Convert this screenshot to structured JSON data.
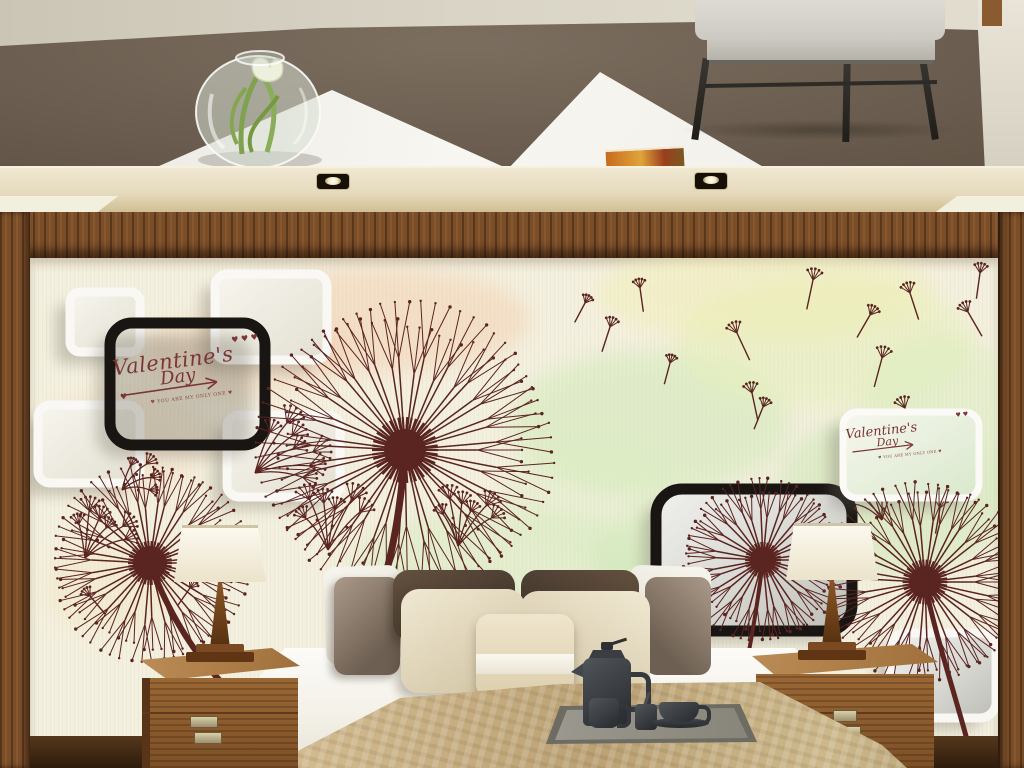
{
  "meta": {
    "title": "Bedroom 3D dandelion wallpaper mural mockup"
  },
  "palette": {
    "dandelion": "#5a2421",
    "black_frame": "#181512",
    "white_box_stroke": "#f9f8f4",
    "cream_wall": "#f4f0df",
    "runner_gold": "#c2ab7e",
    "wood": "#7a4e29"
  },
  "valentine_main": {
    "line1": "Valentine's",
    "line2": "Day",
    "hearts": "♥ ♥ ♥",
    "subtitle": "♥ YOU ARE MY ONLY ONE ♥"
  },
  "valentine_card": {
    "line1": "Valentine's",
    "line2": "Day",
    "hearts": "♥ ♥",
    "subtitle": "♥ YOU ARE MY ONLY ONE ♥"
  },
  "mural": {
    "layers": [
      {
        "type": "watercolors",
        "items": [
          [
            350,
            62,
            150,
            52,
            "#f3cfae",
            0.5
          ],
          [
            215,
            95,
            105,
            42,
            "#f0c9a8",
            0.35
          ],
          [
            80,
            330,
            70,
            45,
            "#f0e3b8",
            0.3
          ],
          [
            90,
            185,
            90,
            52,
            "#f2d4b6",
            0.3
          ],
          [
            620,
            165,
            140,
            72,
            "#cde9b4",
            0.5
          ],
          [
            795,
            85,
            150,
            65,
            "#e4efb6",
            0.5
          ],
          [
            865,
            235,
            120,
            82,
            "#c6e6ae",
            0.45
          ],
          [
            470,
            305,
            150,
            55,
            "#cfe9b8",
            0.4
          ],
          [
            680,
            305,
            120,
            60,
            "#c9e7b2",
            0.45
          ],
          [
            735,
            35,
            170,
            48,
            "#f0eeb4",
            0.5
          ],
          [
            915,
            140,
            80,
            58,
            "#d4ecb8",
            0.4
          ],
          [
            560,
            240,
            90,
            60,
            "#d8edc0",
            0.35
          ]
        ]
      },
      {
        "type": "boxes",
        "items": [
          {
            "x": 40,
            "y": 34,
            "w": 70,
            "h": 60,
            "rx": 10,
            "style": "whiteBox"
          },
          {
            "x": 185,
            "y": 16,
            "w": 112,
            "h": 86,
            "rx": 12,
            "style": "whiteBox"
          },
          {
            "x": 8,
            "y": 147,
            "w": 102,
            "h": 78,
            "rx": 12,
            "style": "whiteBox"
          },
          {
            "x": 197,
            "y": 157,
            "w": 113,
            "h": 82,
            "rx": 12,
            "style": "whiteBox"
          },
          {
            "x": 80,
            "y": 65,
            "w": 155,
            "h": 122,
            "rx": 22,
            "style": "blackFrame"
          }
        ]
      },
      {
        "type": "clusters",
        "items": [
          {
            "x": 55,
            "y": 300,
            "n": 6,
            "a0": -100,
            "a1": -25,
            "len": 48
          },
          {
            "x": 92,
            "y": 232,
            "n": 4,
            "a0": -70,
            "a1": 0,
            "len": 36
          },
          {
            "x": 298,
            "y": 292,
            "n": 6,
            "a0": -125,
            "a1": -50,
            "len": 54
          },
          {
            "x": 428,
            "y": 288,
            "n": 6,
            "a0": -115,
            "a1": -40,
            "len": 48
          },
          {
            "x": 225,
            "y": 215,
            "n": 7,
            "a0": -70,
            "a1": 5,
            "len": 60
          },
          {
            "x": 852,
            "y": 262,
            "n": 5,
            "a0": -150,
            "a1": -70,
            "len": 44
          }
        ]
      },
      {
        "type": "seeds",
        "items": [
          [
            580,
            69,
            18,
            26
          ],
          [
            707,
            75,
            -25,
            30
          ],
          [
            783,
            22,
            12,
            30
          ],
          [
            880,
            35,
            -18,
            28
          ],
          [
            840,
            57,
            30,
            26
          ],
          [
            950,
            15,
            8,
            26
          ],
          [
            938,
            54,
            -30,
            28
          ],
          [
            852,
            100,
            15,
            30
          ],
          [
            722,
            135,
            -12,
            28
          ],
          [
            733,
            149,
            22,
            24
          ],
          [
            610,
            30,
            -8,
            24
          ],
          [
            555,
            45,
            28,
            22
          ],
          [
            875,
            150,
            -22,
            30
          ],
          [
            910,
            250,
            10,
            26
          ],
          [
            640,
            105,
            15,
            22
          ],
          [
            60,
            338,
            -40,
            24
          ],
          [
            160,
            330,
            35,
            22
          ]
        ]
      },
      {
        "type": "dandelions",
        "items": [
          {
            "cx": 375,
            "cy": 192,
            "r": 150,
            "spokes": 46,
            "core": 21,
            "sw": 7,
            "stem": "M375,192 C370,262 360,305 350,335"
          },
          {
            "cx": 120,
            "cy": 305,
            "r": 100,
            "spokes": 38,
            "core": 17,
            "sw": 6,
            "stem": "M120,305 C140,360 170,405 205,438"
          }
        ]
      },
      {
        "type": "boxes",
        "items": [
          {
            "x": 626,
            "y": 231,
            "w": 196,
            "h": 142,
            "rx": 26,
            "style": "blackPanel"
          },
          {
            "x": 813,
            "y": 154,
            "w": 136,
            "h": 86,
            "rx": 14,
            "style": "whiteCard"
          },
          {
            "x": 860,
            "y": 375,
            "w": 106,
            "h": 85,
            "rx": 16,
            "style": "whitePanel"
          }
        ]
      },
      {
        "type": "dandelions",
        "items": [
          {
            "cx": 733,
            "cy": 302,
            "r": 82,
            "spokes": 34,
            "core": 13,
            "sw": 4,
            "stem": "M733,302 C726,360 716,412 706,458"
          },
          {
            "cx": 895,
            "cy": 324,
            "r": 102,
            "spokes": 38,
            "core": 16,
            "sw": 5,
            "stem": "M895,324 C902,365 920,420 936,478"
          }
        ]
      }
    ]
  }
}
